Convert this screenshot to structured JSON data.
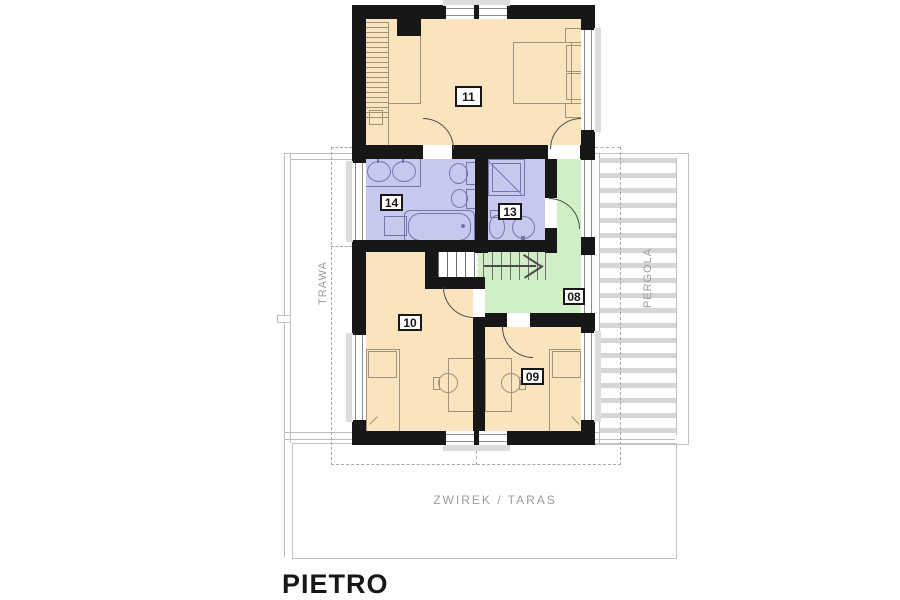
{
  "title": "PIETRO",
  "annotations": {
    "left_area": "TRAWA",
    "right_area": "PERGOLA",
    "bottom_area": "ZWIREK / TARAS"
  },
  "rooms": {
    "r08": {
      "label": "08"
    },
    "r09": {
      "label": "09"
    },
    "r10": {
      "label": "10"
    },
    "r11": {
      "label": "11"
    },
    "r13": {
      "label": "13"
    },
    "r14": {
      "label": "14"
    }
  },
  "colors": {
    "wall": "#171717",
    "room_fill": "#F9E4BE",
    "bathroom_fill": "#C6C8EE",
    "hall_fill": "#D0EFC7",
    "annotation_text": "#9B9B9B"
  }
}
